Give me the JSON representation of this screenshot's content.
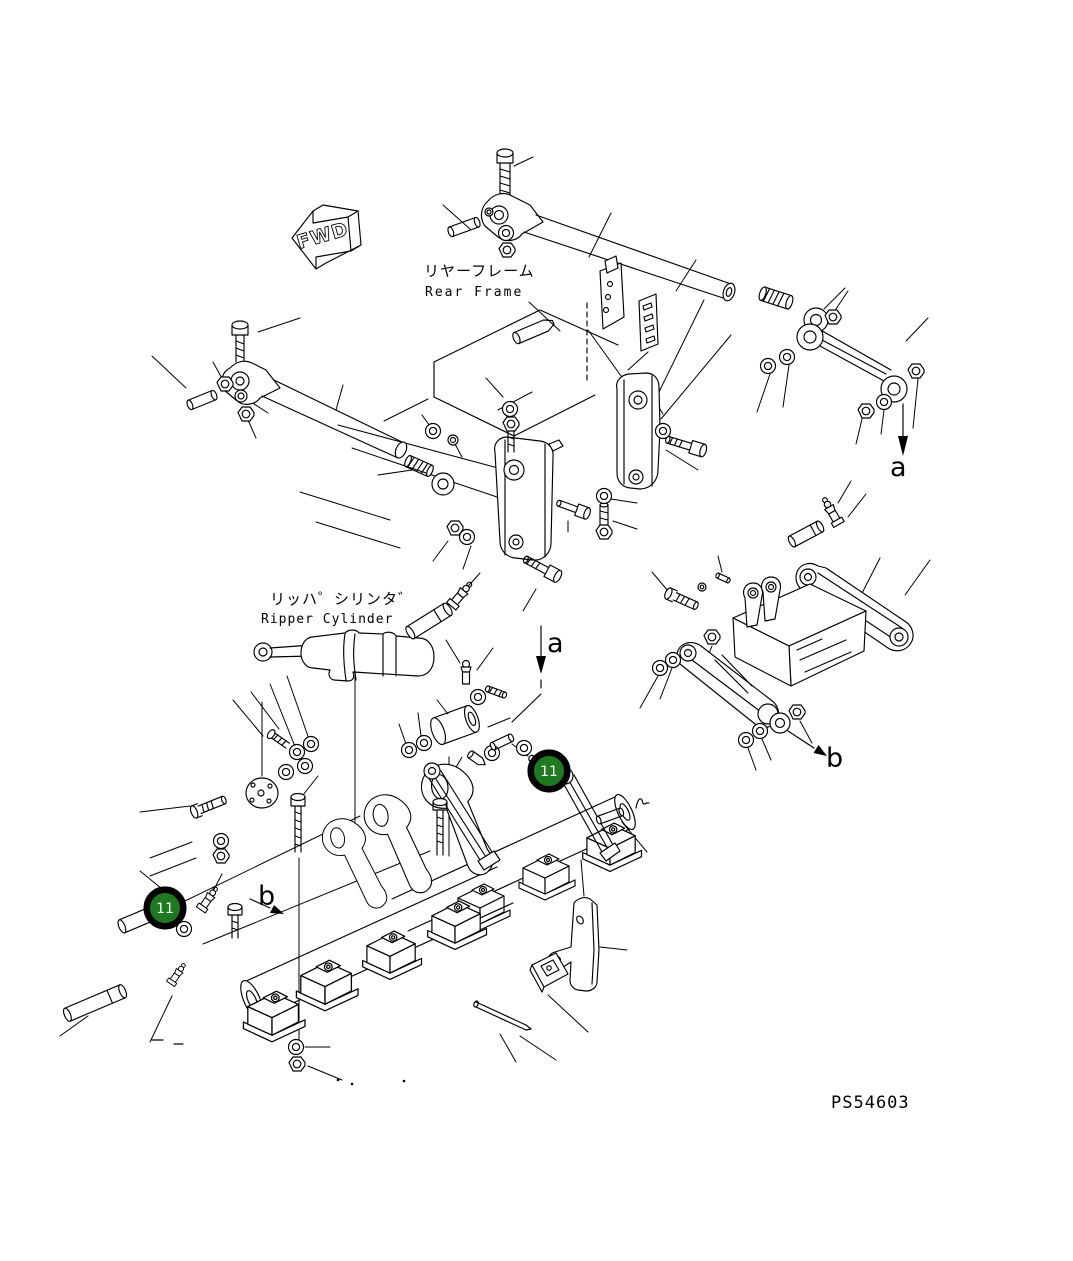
{
  "diagram": {
    "direction_arrow": "FWD",
    "labels": {
      "rear_frame_jp": "リヤーフレーム",
      "rear_frame_en": "Rear Frame",
      "ripper_cylinder_jp": "リッハ゜シリンタ゛",
      "ripper_cylinder_en": "Ripper Cylinder"
    },
    "section_markers": [
      {
        "label": "a",
        "position": "upper-right"
      },
      {
        "label": "a",
        "position": "center"
      },
      {
        "label": "b",
        "position": "right"
      },
      {
        "label": "b",
        "position": "lower-left"
      }
    ],
    "callouts": [
      {
        "number": "11",
        "position": "center-right"
      },
      {
        "number": "11",
        "position": "lower-left"
      }
    ],
    "drawing_number": "PS54603",
    "colors": {
      "callout_fill": "#1e7a1e",
      "callout_ring": "#000000",
      "callout_text": "#ffffff",
      "line": "#000000",
      "background": "#ffffff"
    }
  }
}
